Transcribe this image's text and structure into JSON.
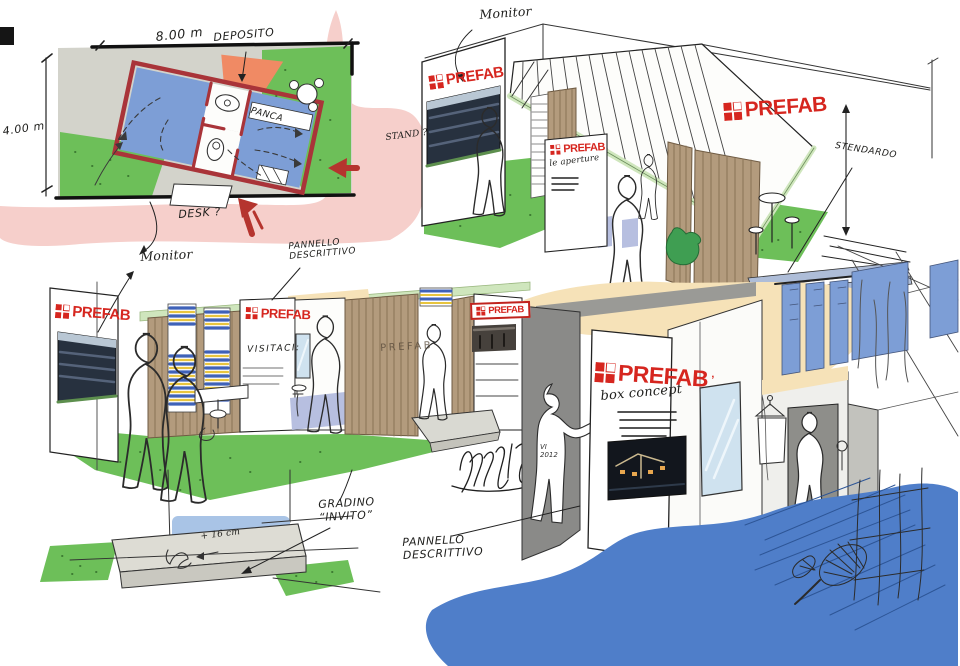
{
  "brand": {
    "name": "PREFAB",
    "mark": "’"
  },
  "plan": {
    "width_dim": "8.00 m",
    "height_dim": "4.00 m",
    "deposito": "DEPOSITO",
    "panca": "PANCA",
    "desk": "DESK ?"
  },
  "exterior": {
    "monitor": "Monitor",
    "stand": "STAND ?",
    "stendardo": "STENDARDO",
    "panel_note": "le aperture"
  },
  "showroom": {
    "monitor": "Monitor",
    "pannello_line1": "PANNELLO",
    "pannello_line2": "DESCRITTIVO",
    "visitaci": "VISITACI:",
    "wall_brand": "PREFAB"
  },
  "step": {
    "gradino_line1": "GRADINO",
    "gradino_line2": "“INVITO”",
    "height": "+ 16 cm"
  },
  "interior": {
    "concept": "box concept",
    "pannello_line1": "PANNELLO",
    "pannello_line2": "DESCRITTIVO"
  },
  "signature": {
    "initials": "VI",
    "year": "2012"
  },
  "colors": {
    "logo_red": "#d6261f",
    "plan_wall_red": "#a93439",
    "room_blue": "#7d9ed6",
    "grass_green": "#6dbf59",
    "pink_highlight": "#f6cfcb",
    "deposito_orange": "#f08a64",
    "wood_tan": "#b39b7d",
    "trim_green": "#cfe6bd",
    "canopy_peach": "#f6e2b8",
    "carpet_blue": "#4f7ec9",
    "arrow_red": "#b5342e",
    "step_wall_blue": "#a9c4e6",
    "mirror_blue": "#cfe2ef",
    "path_gray": "#d3d3cb"
  }
}
